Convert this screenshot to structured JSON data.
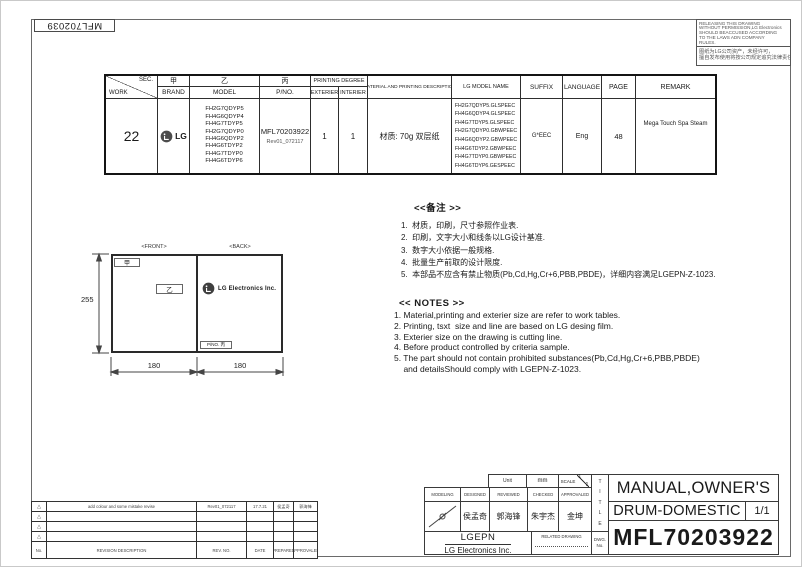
{
  "sheet": {
    "stamp": "MFL702039",
    "notice": {
      "en_lines": [
        "RELEASING THIS DRAWING",
        "WITHOUT PERMISSION,LG Electronics",
        "SHOULD BEACCUSED ACCORDING",
        "TO THE LAWS ADN COMPANY",
        "RULES."
      ],
      "zh_lines": [
        "图纸为LG公司资产，未经许可，",
        "擅自发布使用将按公司规定追究法律责任"
      ]
    }
  },
  "spec_table": {
    "header": {
      "sec": "SEC.",
      "work": "WORK",
      "jia": "甲",
      "brand": "BRAND",
      "yi": "乙",
      "model": "MODEL",
      "bing": "丙",
      "pno": "P/NO.",
      "printing_degree": "PRINTING DEGREE",
      "exterier": "EXTERIER",
      "interier": "INTERIER",
      "material": "MATERIAL AND PRINTING DESCRIPTION",
      "lg_model_name": "LG MODEL NAME",
      "suffix": "SUFFIX",
      "language": "LANGUAGE",
      "page": "PAGE",
      "remark": "REMARK"
    },
    "row": {
      "work": "22",
      "brand": "LG",
      "models": [
        "FH2G7QDYP5",
        "FH4G6QDYP4",
        "FH4G7TDYP5",
        "FH2G7QDYP0",
        "FH4G6QDYP2",
        "FH4G6TDYP2",
        "FH4G7TDYP0",
        "FH4G6TDYP6"
      ],
      "pno": "MFL70203922",
      "pno_rev": "Rev01_072117",
      "exterier": "1",
      "interier": "1",
      "material": "材质: 70g 双层纸",
      "lg_model_names": [
        "FH2G7QDYP5.GLSPEEC",
        "FH4G6QDYP4.GLSPEEC",
        "FH4G7TDYP5.GLSPEEC",
        "FH2G7QDYP0.GBWPEEC",
        "FH4G6QDYP2.GBWPEEC",
        "FH4G6TDYP2.GBWPEEC",
        "FH4G7TDYP0.GBWPEEC",
        "FH4G6TDYP6.GESPEEC"
      ],
      "suffix": "G*EEC",
      "language": "Eng",
      "page": "48",
      "remark": "Mega Touch Spa Steam"
    }
  },
  "drawing": {
    "front_label": "<FRONT>",
    "back_label": "<BACK>",
    "front_tag_top": "甲",
    "front_tag_mid": "乙",
    "logo_text": "LG Electronics Inc.",
    "pno_tag": "P/NO. 丙",
    "dim_height": "255",
    "dim_front_width": "180",
    "dim_back_width": "180"
  },
  "notes_zh": {
    "title": "<<备注 >>",
    "lines": [
      "1.  材质，印刷，尺寸参照作业表.",
      "2.  印刷，文字大小和线条以LG设计基准.",
      "3.  数字大小依据一般规格.",
      "4.  批量生产前取的设计限度.",
      "5.  本部品不应含有禁止物质(Pb,Cd,Hg,Cr+6,PBB,PBDE)，详细内容满足LGEPN-Z-1023."
    ]
  },
  "notes_en": {
    "title": "<< NOTES >>",
    "lines": [
      "1. Material,printing and exterier size are refer to work tables.",
      "2. Printing, tsxt  size and line are based on LG desing film.",
      "3. Exterier size on the drawing is cutting line.",
      "4. Before product controlled by criteria sample.",
      "5. The part should not contain prohibited substances(Pb,Cd,Hg,Cr+6,PBB,PBDE)",
      "    and detailsShould comply with LGEPN-Z-1023."
    ]
  },
  "revision_table": {
    "col_headers": {
      "no": "No.",
      "description": "REVISION DESCRIPTION",
      "rev_no": "REV. NO.",
      "date": "DATE",
      "prepared": "PREPARED",
      "approvaled": "APPROVALED"
    },
    "rows": [
      {
        "no": "△",
        "description": "add colour and some mistake revise",
        "rev_no": "Rev01_072117",
        "date": "17.7.21",
        "prepared": "侯孟奇",
        "approvaled": "郭海锋"
      },
      {
        "no": "△",
        "description": "",
        "rev_no": "",
        "date": "",
        "prepared": "",
        "approvaled": ""
      },
      {
        "no": "△",
        "description": "",
        "rev_no": "",
        "date": "",
        "prepared": "",
        "approvaled": ""
      },
      {
        "no": "△",
        "description": "",
        "rev_no": "",
        "date": "",
        "prepared": "",
        "approvaled": ""
      }
    ]
  },
  "title_block": {
    "unit_label": "Unit",
    "unit_value": "mm",
    "scale_label": "SCALE",
    "scale_top": "1",
    "scale_bottom": "1",
    "modeling_label": "MODELING",
    "designed_label": "DESIGNED",
    "reviewed_label": "REVIEWED",
    "checked_label": "CHECKED",
    "approvaled_label": "APPROVALED",
    "designed": "侯孟奇",
    "reviewed": "郭海锋",
    "checked": "朱宇杰",
    "approvaled": "金坤",
    "company_short": "LGEPN",
    "company_full": "LG Electronics Inc.",
    "related_drawing_label": "RELATED DRAWING",
    "title_vertical": "T\nI\nT\nL\nE",
    "dwg_no_label": "DWG.\nNo.",
    "title_line1": "MANUAL,OWNER'S",
    "title_line2": "DRUM-DOMESTIC",
    "sheet_no": "1/1",
    "dwg_no": "MFL70203922"
  }
}
